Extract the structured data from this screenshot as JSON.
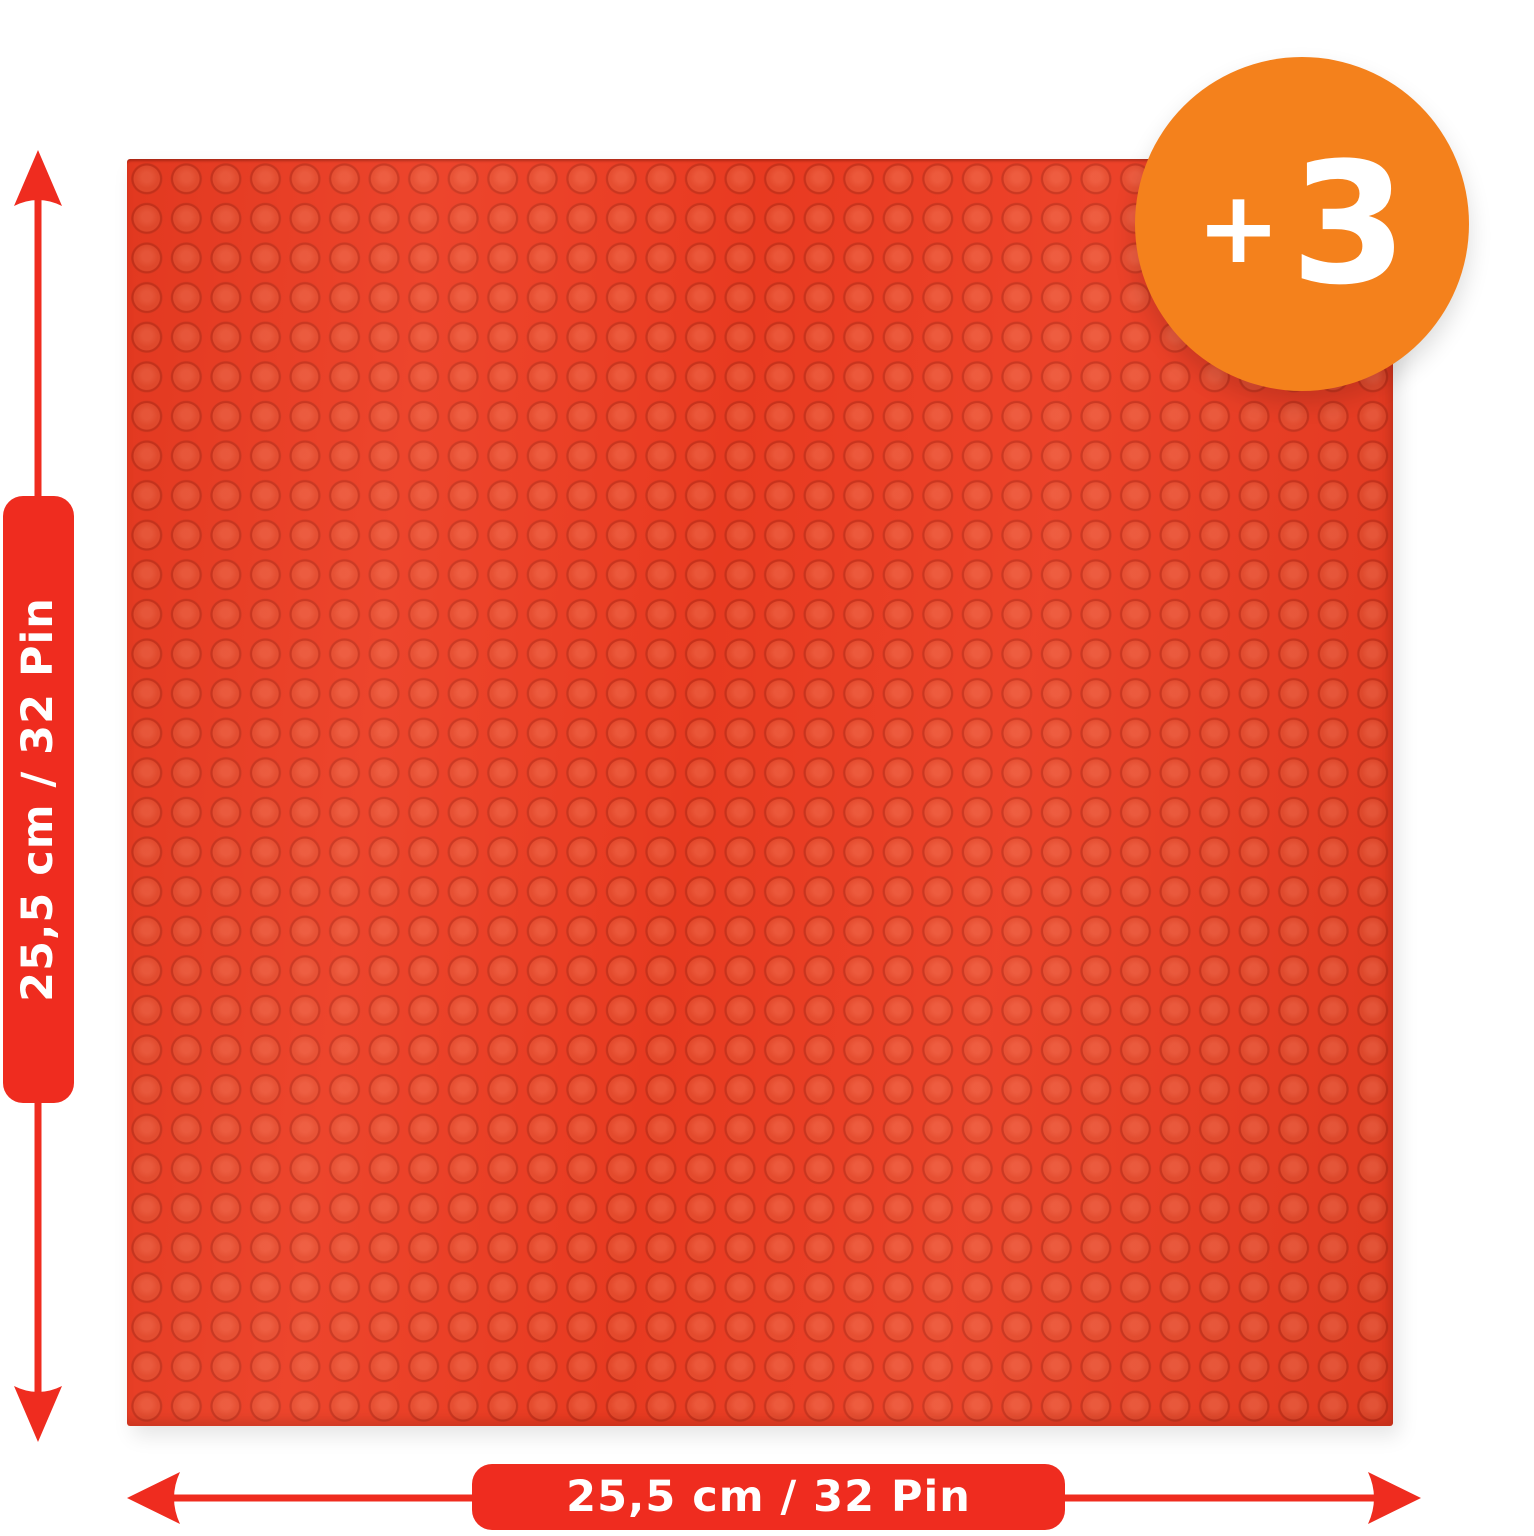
{
  "image": {
    "description": "Red 32x32 stud toy building baseplate product photo with dimension annotations",
    "background": "#ffffff"
  },
  "badge": {
    "plus": "+",
    "count": "3"
  },
  "dimension_labels": {
    "vertical": "25,5 cm / 32 Pin",
    "horizontal": "25,5 cm / 32 Pin"
  },
  "baseplate": {
    "studs_x": 32,
    "studs_y": 32
  },
  "colors": {
    "red": "#ef2c1f",
    "plate": "#ec3b21",
    "stud": "#e74a2c",
    "stud-ring": "#c9321b",
    "orange": "#f4811c",
    "text": "#ffffff"
  }
}
